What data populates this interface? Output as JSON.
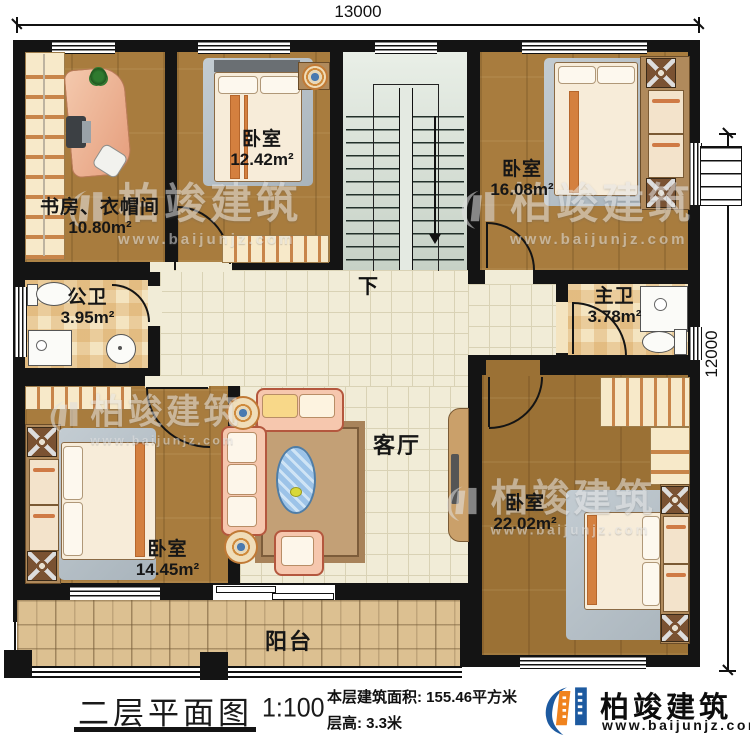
{
  "dimensions": {
    "top": "13000",
    "right": "12000"
  },
  "plan": {
    "rooms": [
      {
        "key": "study",
        "name": "书房、衣帽间",
        "area": "10.80m²"
      },
      {
        "key": "bedroom_tl",
        "name": "卧室",
        "area": "12.42m²"
      },
      {
        "key": "bedroom_tr",
        "name": "卧室",
        "area": "16.08m²"
      },
      {
        "key": "public_bath",
        "name": "公卫",
        "area": "3.95m²"
      },
      {
        "key": "master_bath",
        "name": "主卫",
        "area": "3.78m²"
      },
      {
        "key": "living",
        "name": "客厅"
      },
      {
        "key": "bedroom_bl",
        "name": "卧室",
        "area": "14.45m²"
      },
      {
        "key": "bedroom_br",
        "name": "卧室",
        "area": "22.02m²"
      },
      {
        "key": "balcony",
        "name": "阳台"
      }
    ],
    "stairs": {
      "down_label": "下"
    }
  },
  "footer": {
    "title": "二层平面图",
    "scale": "1:100",
    "area_line": "本层建筑面积: 155.46平方米",
    "height_line": "层高: 3.3米"
  },
  "brand": {
    "name": "柏竣建筑",
    "website": "www.baijunjz.com"
  },
  "watermark": {
    "name": "柏竣建筑",
    "website": "www.baijunjz.com"
  },
  "colors": {
    "accent_blue": "#1d5aa0",
    "accent_orange": "#f0831e"
  }
}
